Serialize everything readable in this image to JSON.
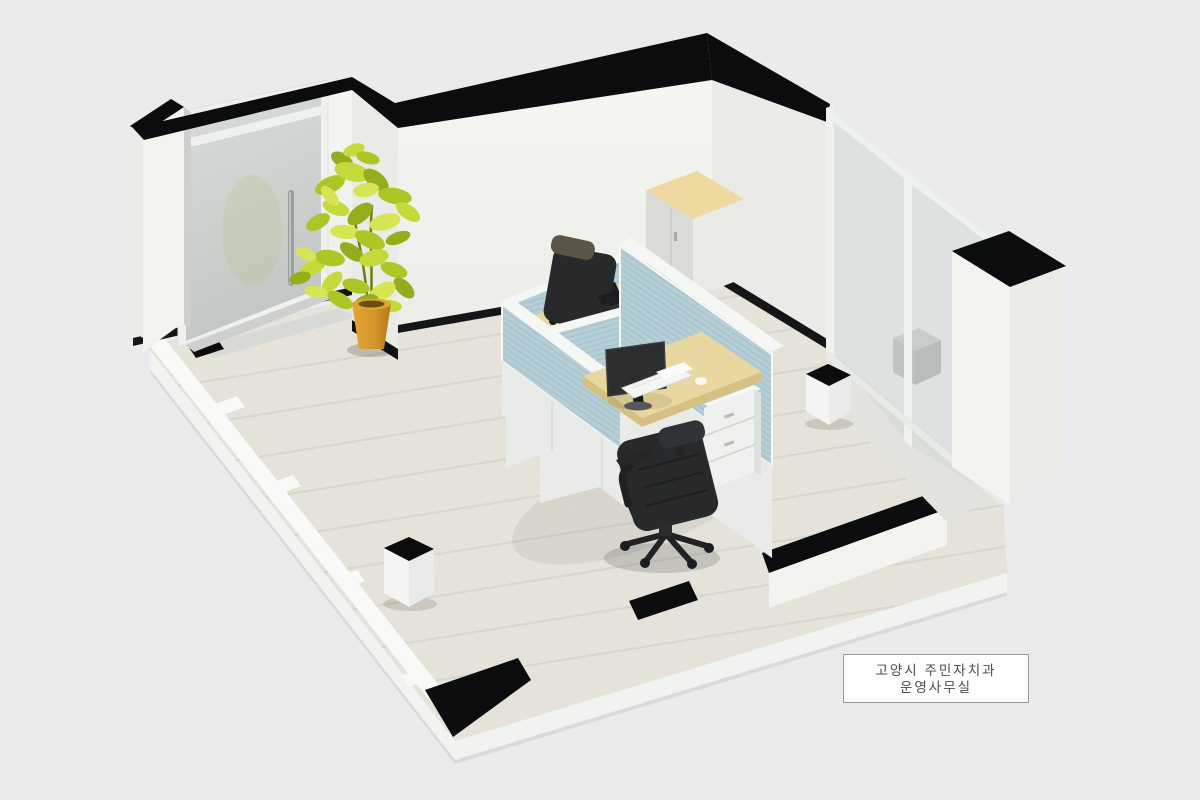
{
  "scene": {
    "description": "3D isometric cutaway render of a small office room",
    "room_label": {
      "line1": "고양시 주민자치과",
      "line2": "운영사무실"
    },
    "objects": [
      "entrance-door",
      "potted-plant",
      "storage-cabinet",
      "cubicle-workstations",
      "office-chair-far",
      "office-chair-near",
      "monitor-far",
      "monitor-near",
      "keyboard",
      "drawer-pedestal",
      "glass-partition",
      "trash-bin-1",
      "trash-bin-2"
    ]
  },
  "palette": {
    "background": "#e9ebec",
    "floor": "#e9e7dd",
    "floor_alcove": "#d8dad6",
    "slab": "#f1f3f1",
    "slab_shade": "#d9dbd9",
    "rail": "#f8faf8",
    "cut_black": "#0b0c0d",
    "baseboard": "#141516",
    "wall": "#f3f4f0",
    "wall_shade": "#e9ebe6",
    "wall_dark": "#dfe2de",
    "jamb": "#cdd0cd",
    "glass": "#ccd4d2",
    "glass_frame": "#eff1ef",
    "partition_blue": "#b6cfd7",
    "partition_blue_line": "#a6c4cd",
    "partition_white": "#e9ebe9",
    "partition_cap": "#f5f7f5",
    "desk": "#e9d7a0",
    "desk_edge": "#d6c183",
    "cabinet_top": "#eeda9e",
    "cabinet_face": "#dadcd8",
    "cabinet_side": "#e9ebe7",
    "monitor": "#2c2e30",
    "chair": "#27292b",
    "chair_dark": "#1b1d1e",
    "chair_head": "#5a5544",
    "drawer": "#eff1ef",
    "keyboard": "#f5f6f3",
    "pot": "#d89b2c",
    "pot_rim": "#dfa334",
    "soil": "#6b4d17",
    "leaf_a": "#aec526",
    "leaf_b": "#c6d93a",
    "leaf_c": "#93ad1d",
    "leaf_d": "#d9e455",
    "stem": "#6e7d12",
    "plank": "#a8a69a",
    "label_bg": "#fdfdfd",
    "label_border": "#97999b",
    "label_text": "#4b4d4f"
  }
}
